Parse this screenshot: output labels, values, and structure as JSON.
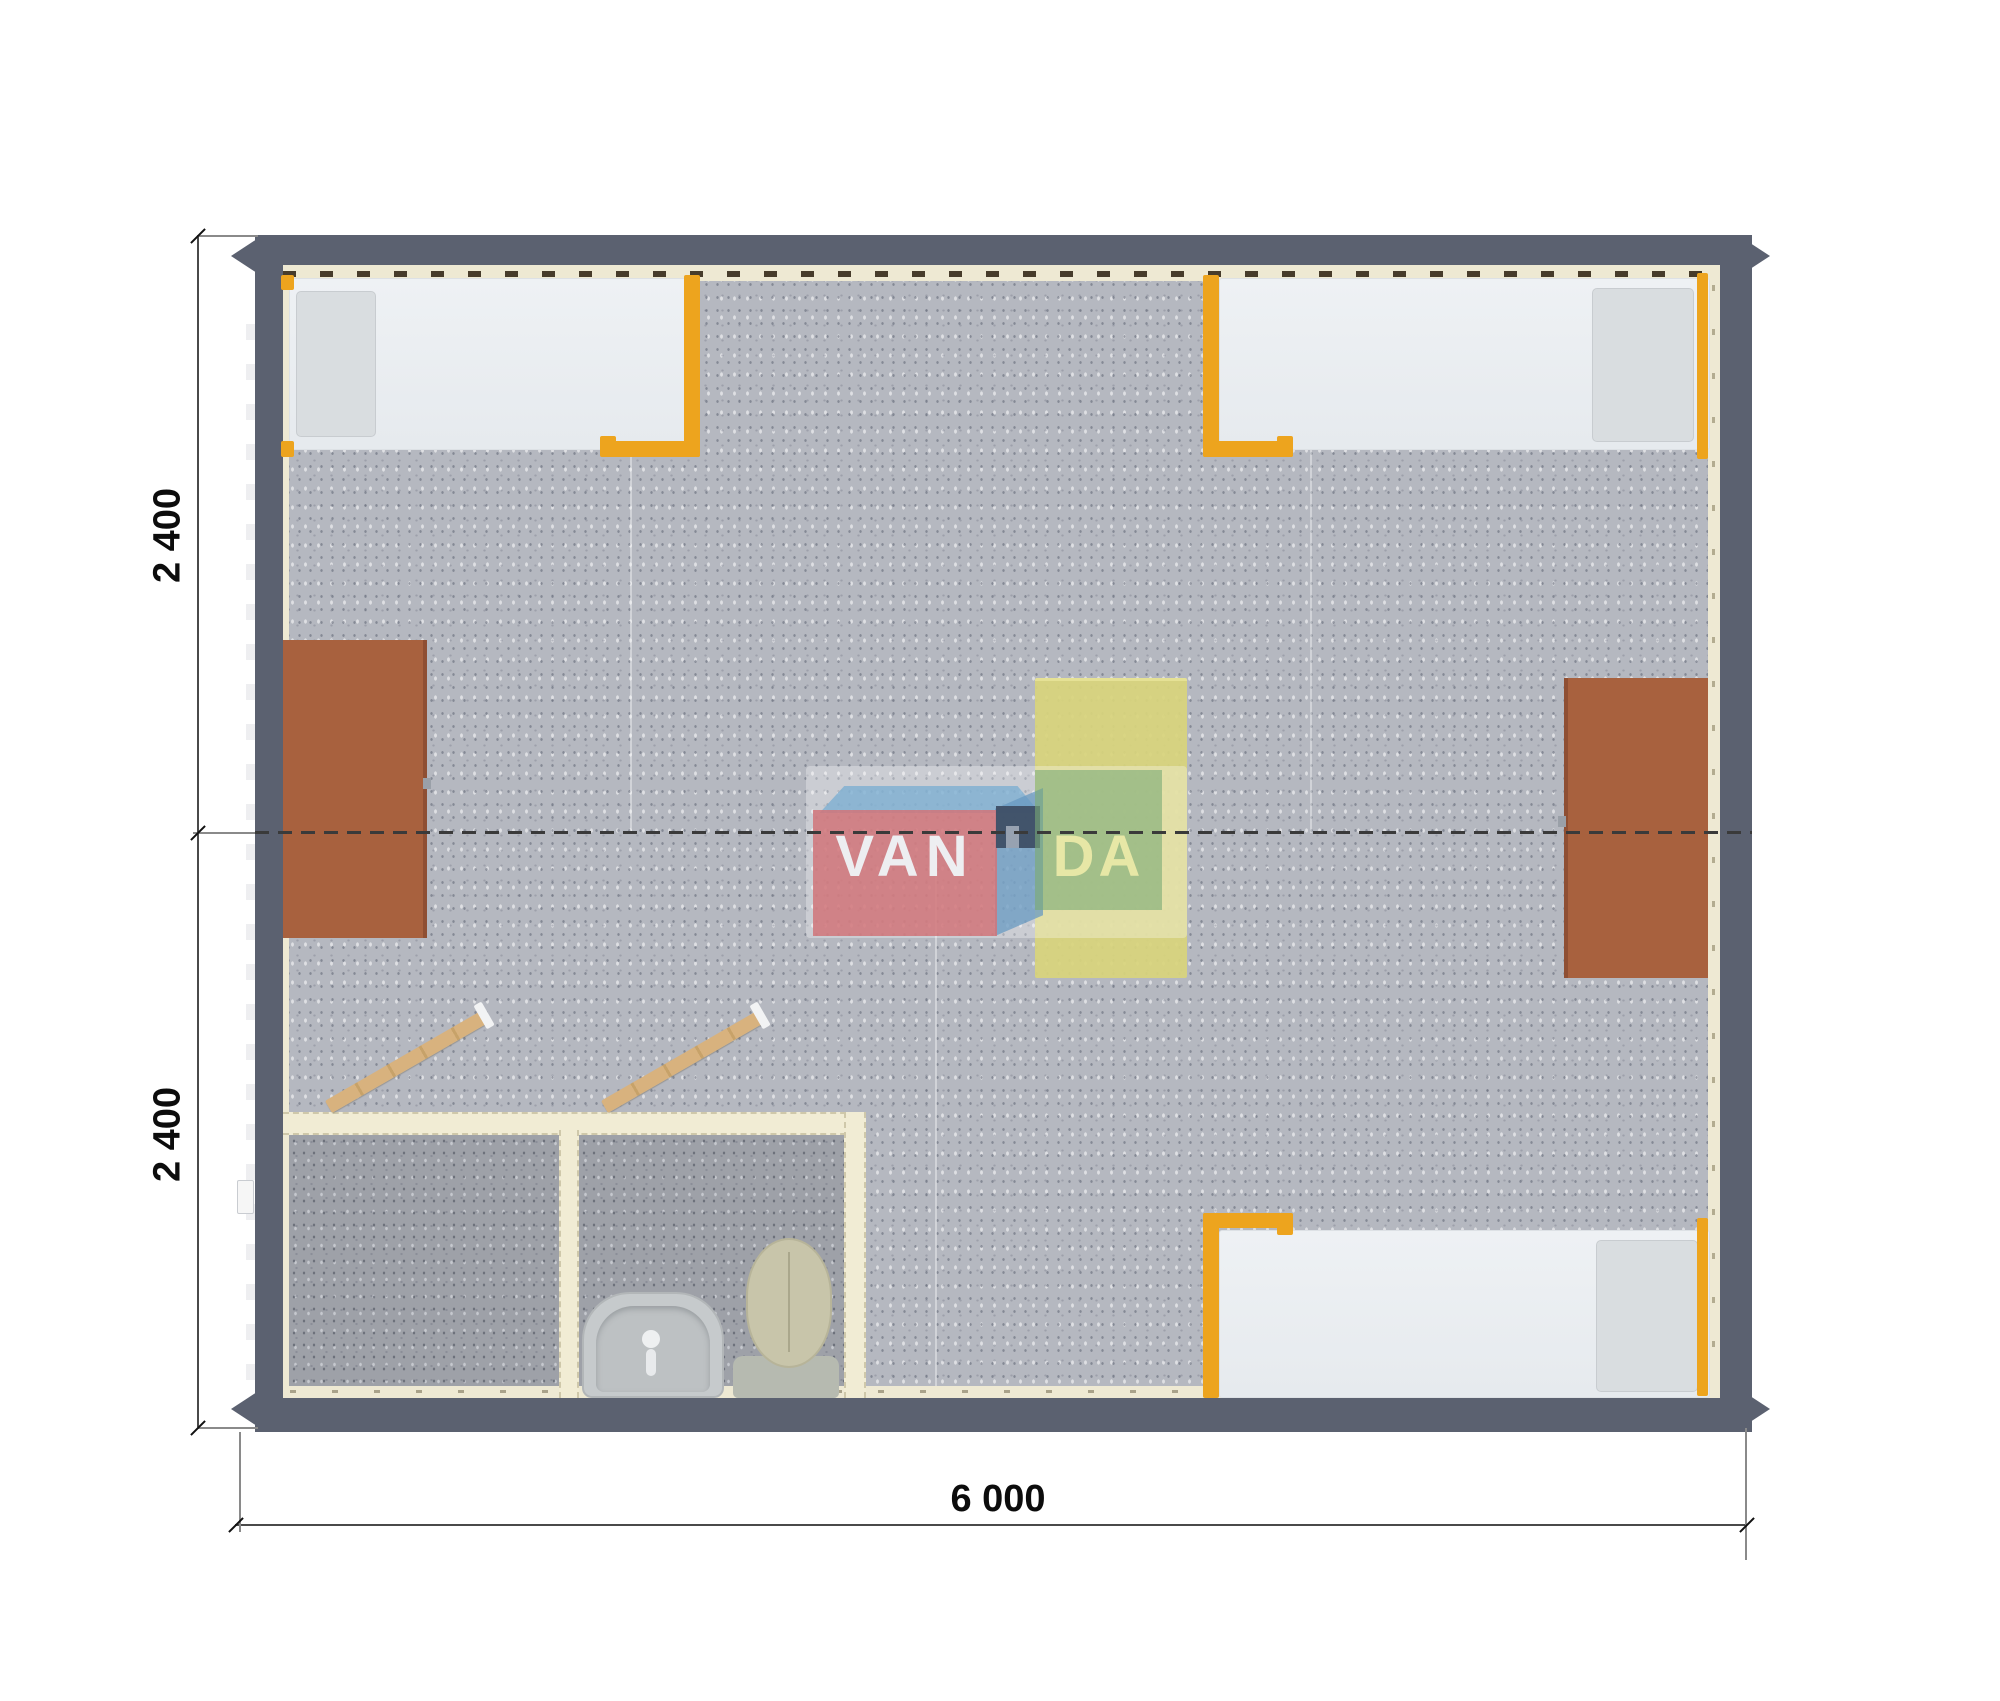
{
  "plan": {
    "kind": "floor-plan-top-view",
    "building": "modular cabin 6000 x 4800 mm",
    "rooms": [
      "main room",
      "entry room",
      "bathroom"
    ]
  },
  "dimensions": {
    "left_top": "2 400",
    "left_bottom": "2 400",
    "bottom": "6 000"
  },
  "watermark": {
    "brand": "VANDA",
    "left_text": "VAN",
    "right_text": "DA"
  },
  "elements": {
    "beds": [
      "bed-top-left",
      "bed-top-right",
      "bed-bottom-right"
    ],
    "cabinets": [
      "cabinet-left",
      "cabinet-right"
    ],
    "table": "table-center",
    "bathroom_fixtures": [
      "sink",
      "toilet"
    ],
    "doors": [
      "door-entry-room",
      "door-bathroom"
    ]
  },
  "colors": {
    "wall": "#5b6170",
    "floor": "#b5b8c0",
    "floor_dark": "#9ea1a8",
    "liner": "#eee9d3",
    "bed_frame_orange": "#eda41e",
    "mattress": "#eaeef1",
    "pillow": "#d9dde0",
    "cabinet_brown": "#a8613e",
    "table_yellow": "#d8d47c",
    "door_wood": "#d8b27e",
    "logo_pink": "#d17479",
    "logo_blue": "#7dafd2",
    "logo_green": "#7aaa74",
    "logo_navy": "#3e4f66",
    "dimension_text": "#0c0c0c"
  }
}
